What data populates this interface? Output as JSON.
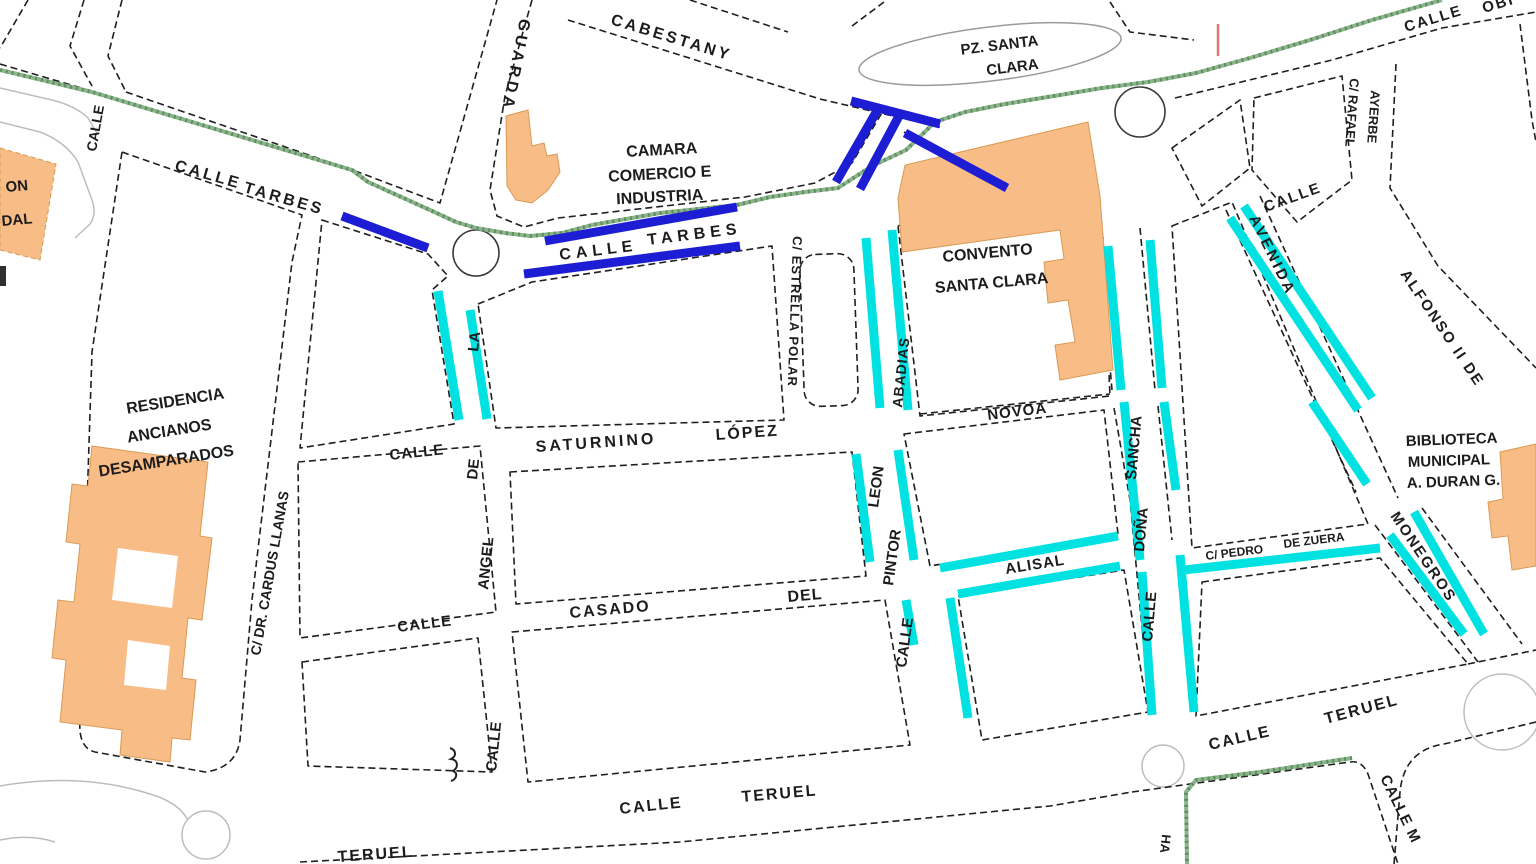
{
  "map": {
    "colors": {
      "building_fill": "#f8bc86",
      "highlight_blue": "#1d1dd4",
      "highlight_cyan": "#00e2e2",
      "path_green": "#5d8f5d",
      "road_edge": "#1f1f1f",
      "minor_road": "#bdbdbd",
      "marker_red": "#e07878"
    },
    "places": {
      "pz_santa_clara_line1": "PZ. SANTA",
      "pz_santa_clara_line2": "CLARA",
      "camara_line1": "CAMARA",
      "camara_line2": "COMERCIO E",
      "camara_line3": "INDUSTRIA",
      "convento_line1": "CONVENTO",
      "convento_line2": "SANTA CLARA",
      "residencia_line1": "RESIDENCIA",
      "residencia_line2": "ANCIANOS",
      "residencia_line3": "DESAMPARADOS",
      "biblioteca_line1": "BIBLIOTECA",
      "biblioteca_line2": "MUNICIPAL",
      "biblioteca_line3": "A. DURAN G.",
      "partial_left_line1": "ON",
      "partial_left_line2": "DAL"
    },
    "streets": {
      "cabestany": "CABESTANY",
      "calle_top_left": "CALLE",
      "tarbes_w_calle": "CALLE",
      "tarbes_w_name": "TARBES",
      "guarda": "GUARDA",
      "tarbes_e_calle": "CALLE",
      "tarbes_e_name": "TARBES",
      "estrella_polar": "C/ ESTRELLA POLAR",
      "abadias": "ABADIAS",
      "rafael_ayerbe_1": "C/ RAFAEL",
      "rafael_ayerbe_2": "AYERBE",
      "calle_ne": "CALLE",
      "obispo_calle": "CALLE",
      "obispo_name": "OBI",
      "alfonso": "ALFONSO II DE",
      "avenida": "AVENIDA",
      "monegros": "MONEGROS",
      "cardus": "C/ DR. CARDUS LLANAS",
      "la": "LA",
      "de": "DE",
      "saturnino_calle": "CALLE",
      "saturnino": "SATURNINO",
      "lopez": "LÓPEZ",
      "novoa": "NOVOA",
      "angel": "ANGEL",
      "angel_calle": "CALLE",
      "casado_calle": "CALLE",
      "casado": "CASADO",
      "del": "DEL",
      "leon": "LEON",
      "pintor": "PINTOR",
      "pintor_calle": "CALLE",
      "alisal": "ALISAL",
      "sancha": "SANCHA",
      "dona": "DOÑA",
      "dona_calle": "CALLE",
      "pedro_1": "C/ PEDRO",
      "pedro_2": "DE ZUERA",
      "teruel_c_calle": "CALLE",
      "teruel_c_name": "TERUEL",
      "teruel_e_calle": "CALLE",
      "teruel_e_name": "TERUEL",
      "teruel_sw": "TERUEL",
      "calle_m": "CALLE M",
      "ha_partial": "HA"
    }
  }
}
